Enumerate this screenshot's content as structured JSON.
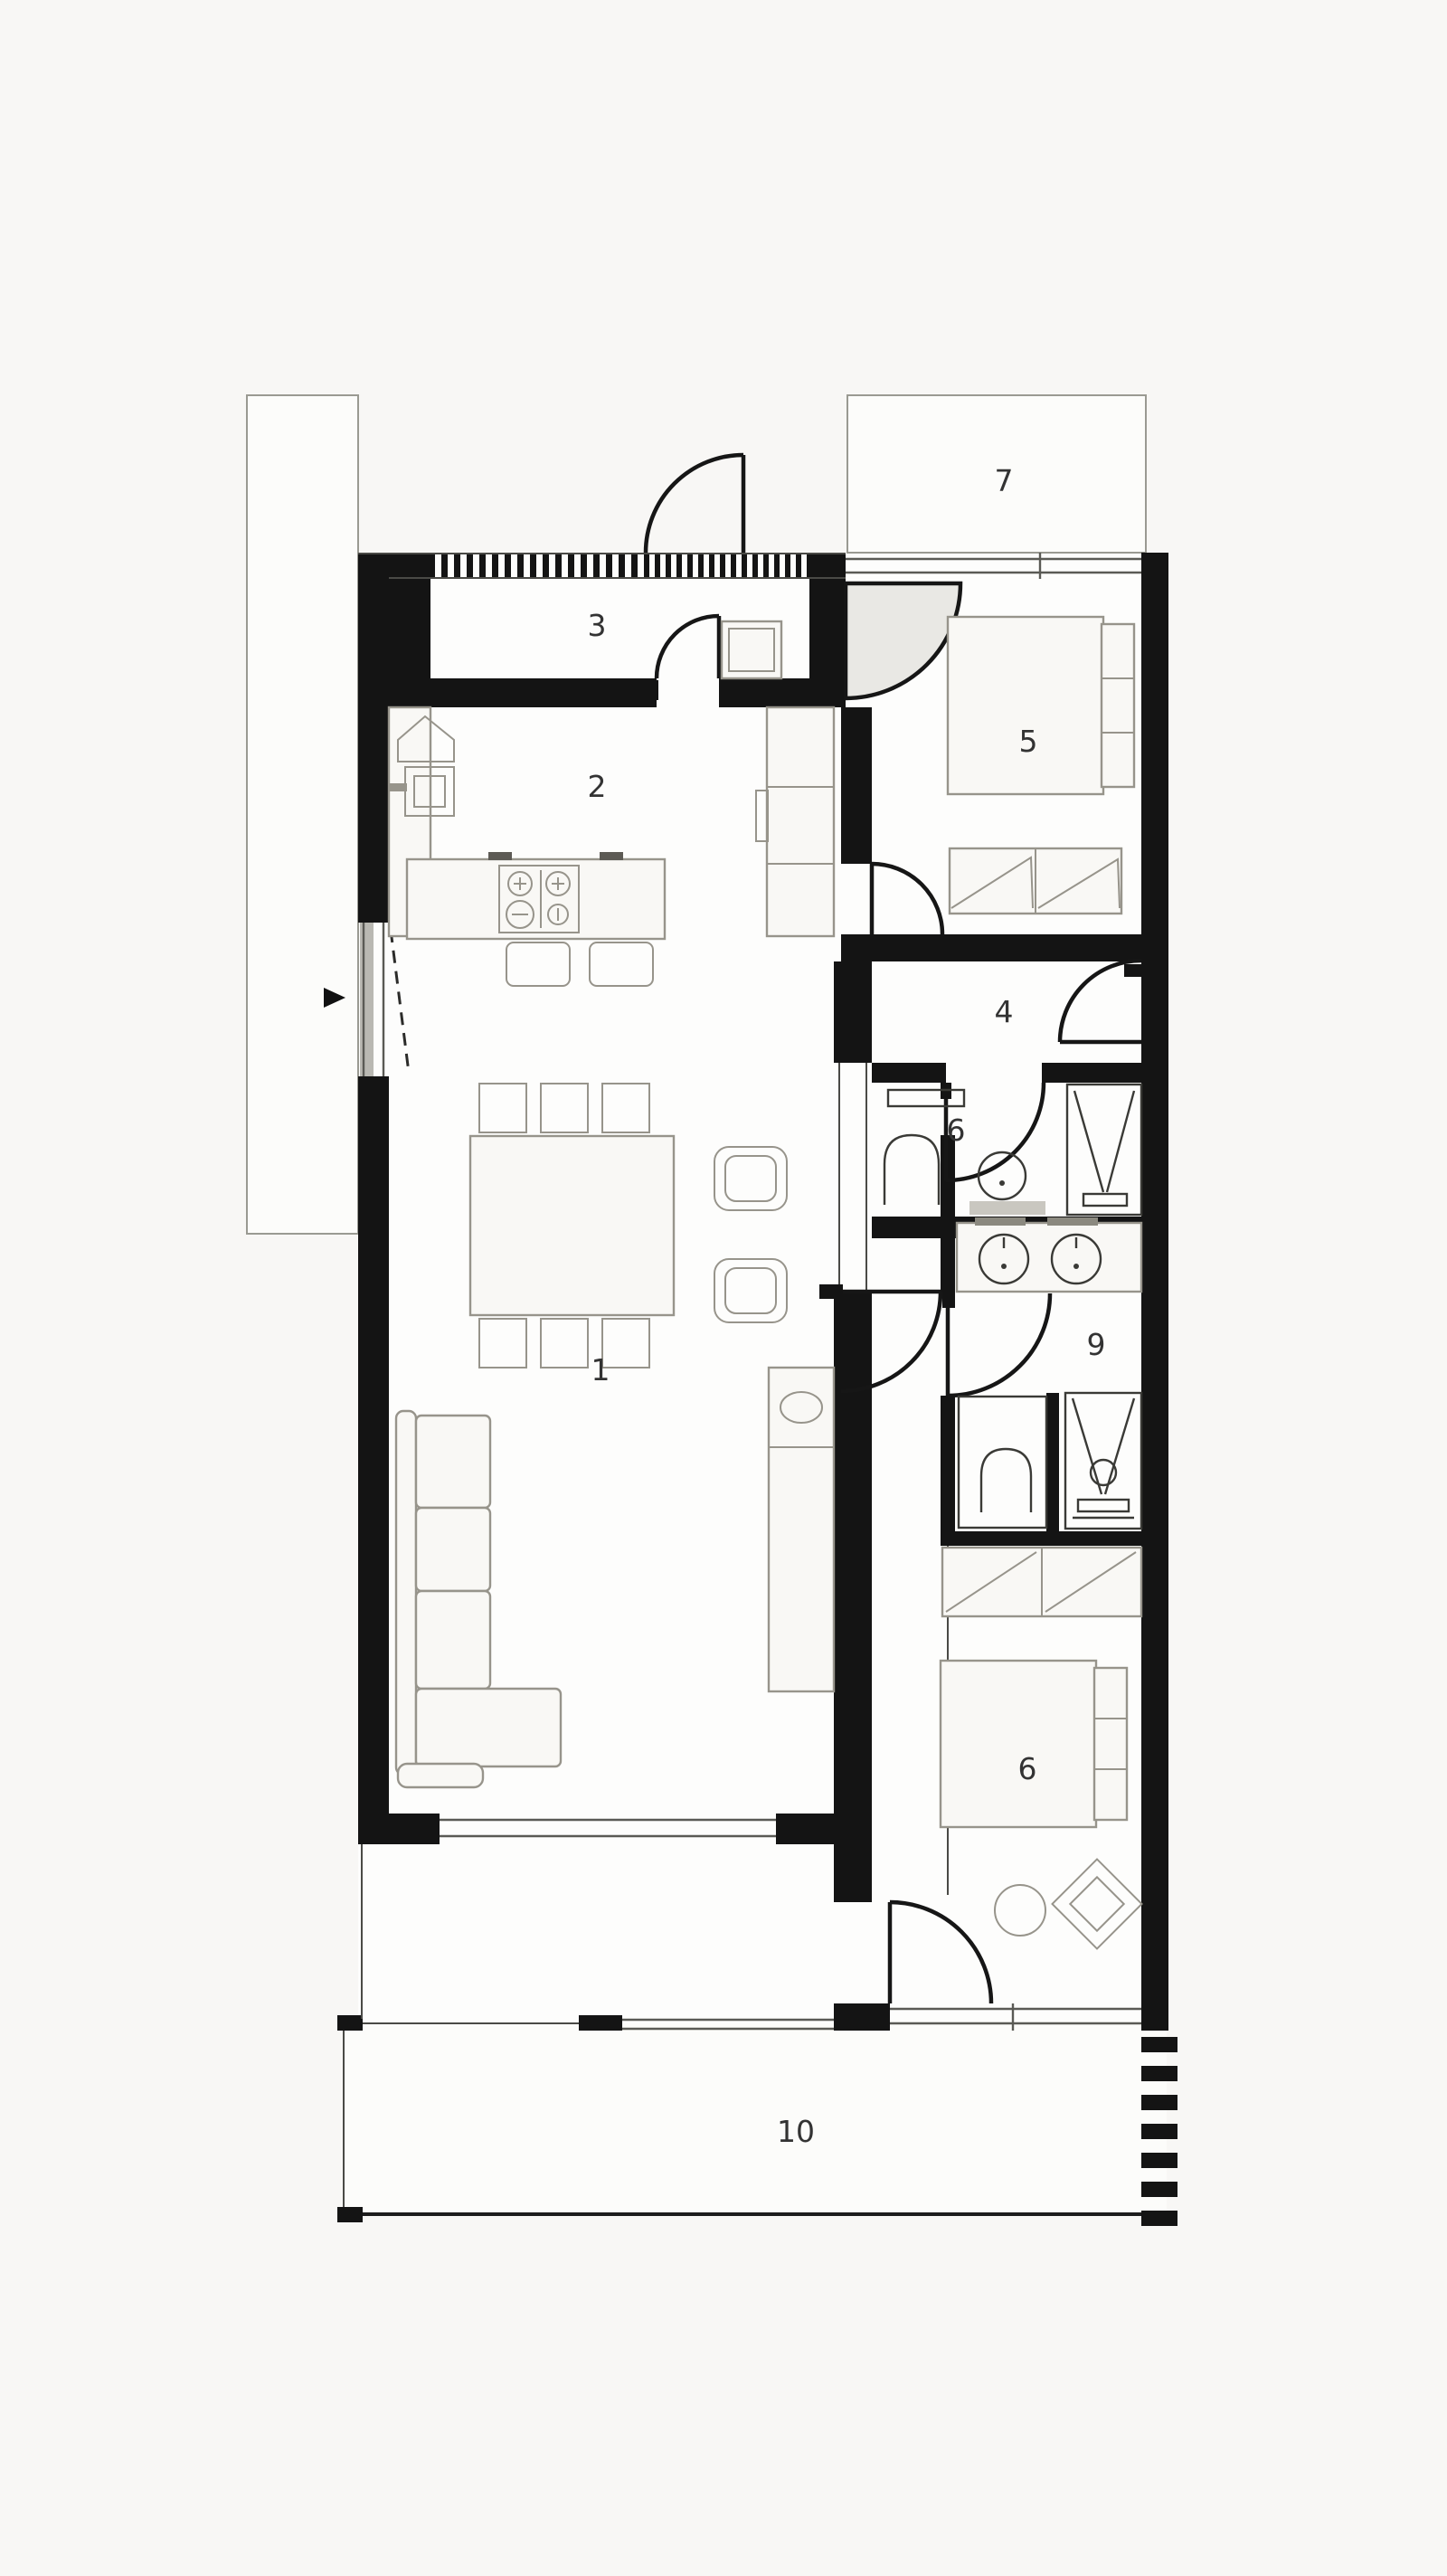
{
  "plan": {
    "kind": "architectural floor plan, top view, black and white",
    "labels": {
      "living": "1",
      "kitchen": "2",
      "entry_hall": "3",
      "hallway": "4",
      "bedroom_main": "5",
      "bathroom": "6",
      "terrace_top": "7",
      "shower_room": "9",
      "bedroom_second": "6",
      "terrace_bottom": "10"
    },
    "icons": {
      "entry_arrow": "black triangle pointing right at entrance"
    },
    "colors": {
      "wall": "#141414",
      "floor": "#fdfdfc",
      "background": "#f7f6f4",
      "furniture_line": "#97948b",
      "label_text": "#333333",
      "door_swing_shade": "#e9e8e4"
    }
  }
}
